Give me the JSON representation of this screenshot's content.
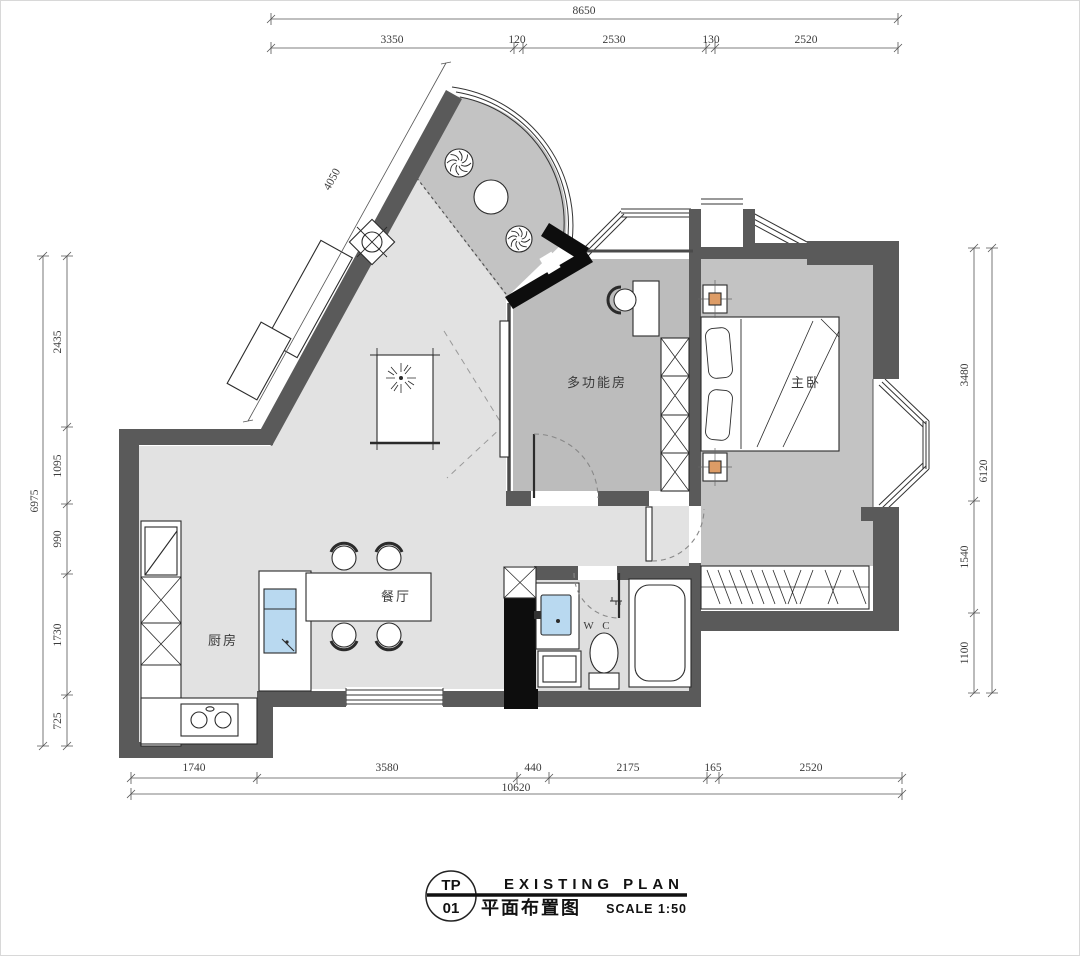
{
  "title_block": {
    "sheet_prefix": "TP",
    "sheet_number": "01",
    "title_en": "EXISTING PLAN",
    "title_cn": "平面布置图",
    "scale_label": "SCALE 1:50"
  },
  "room_labels": {
    "multifunction_room": "多功能房",
    "master_bedroom": "主卧",
    "dining_room": "餐厅",
    "kitchen": "厨房",
    "wc": "W C"
  },
  "dimensions": {
    "top": {
      "total": "8650",
      "segments": [
        "3350",
        "120",
        "2530",
        "130",
        "2520"
      ]
    },
    "bottom": {
      "total": "10620",
      "segments": [
        "1740",
        "3580",
        "440",
        "2175",
        "165",
        "2520"
      ]
    },
    "left": {
      "total": "6975",
      "segments": [
        "2435",
        "1095",
        "990",
        "1730",
        "725"
      ]
    },
    "right": {
      "total": "6120",
      "segments": [
        "3480",
        "1540",
        "1100"
      ]
    },
    "diagonal_wall": "4050"
  },
  "colors": {
    "wall_dark": "#5a5a5a",
    "wall_black": "#0d0d0d",
    "floor_living": "#e2e2e2",
    "floor_balcony": "#c3c3c3",
    "floor_room": "#bcbcbc",
    "floor_wc": "#dedede",
    "fixture_blue": "#b9d9f0",
    "accent_orange": "#dd9c66"
  }
}
